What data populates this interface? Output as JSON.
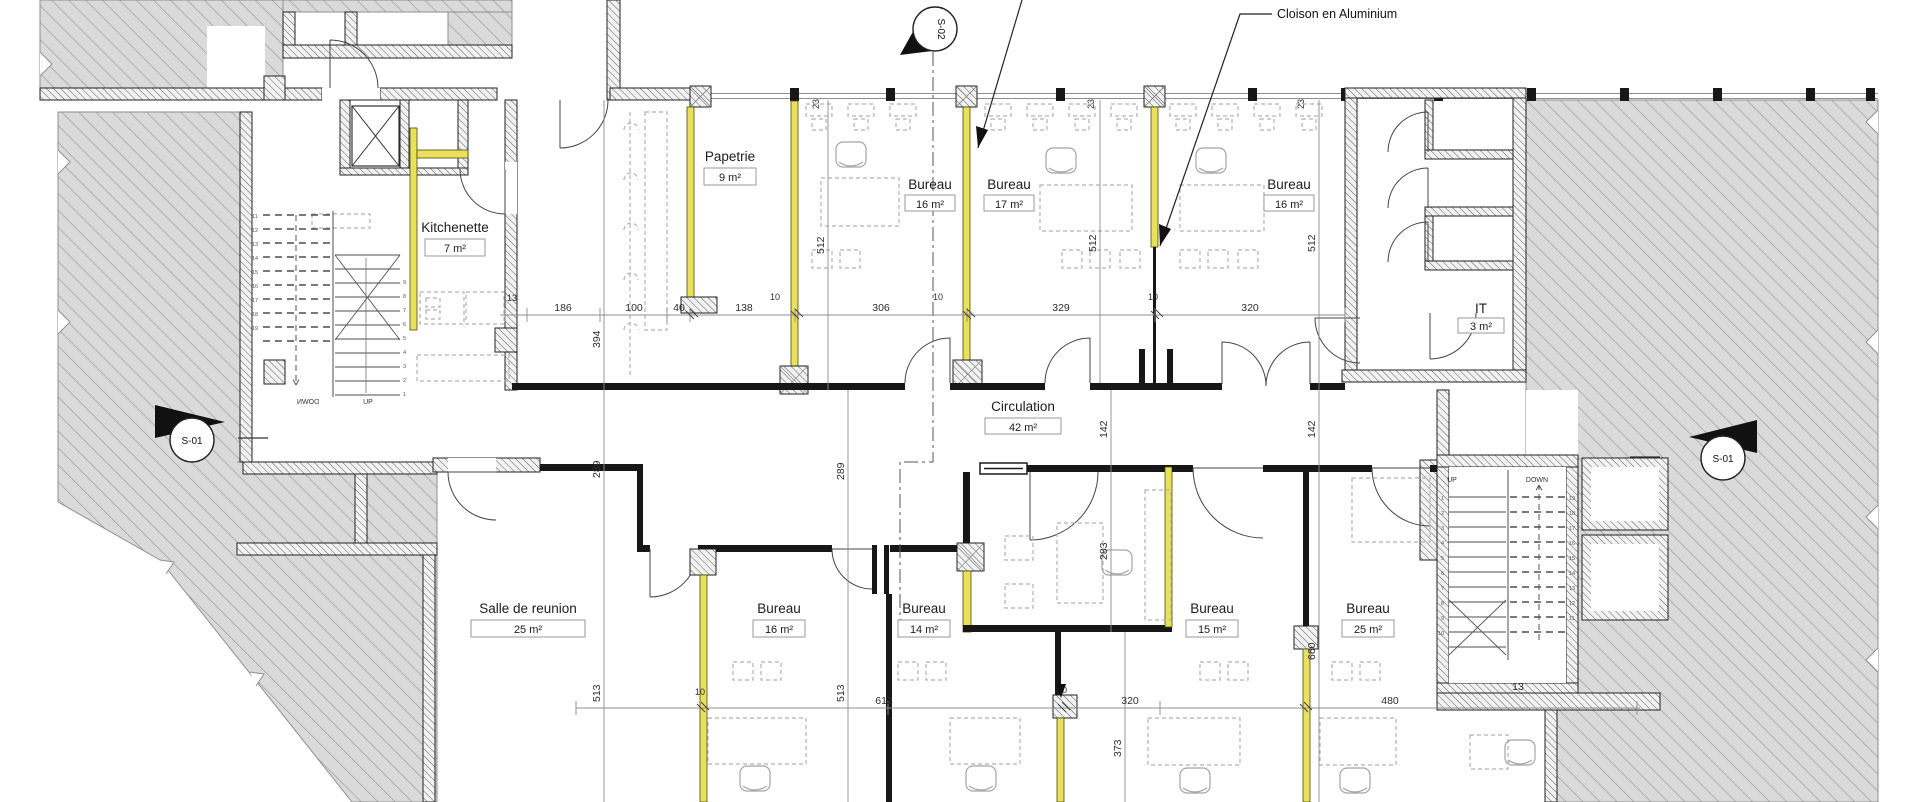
{
  "plan": {
    "annotation": {
      "cloison": "Cloison en Aluminium"
    },
    "rooms": {
      "papetrie": {
        "name": "Papetrie",
        "area": "9 m²"
      },
      "kitchenette": {
        "name": "Kitchenette",
        "area": "7 m²"
      },
      "bureau_t1": {
        "name": "Bureau",
        "area": "16 m²"
      },
      "bureau_t2": {
        "name": "Bureau",
        "area": "17 m²"
      },
      "bureau_t3": {
        "name": "Bureau",
        "area": "16 m²"
      },
      "it": {
        "name": "IT",
        "area": "3 m²"
      },
      "circulation": {
        "name": "Circulation",
        "area": "42 m²"
      },
      "salle": {
        "name": "Salle de reunion",
        "area": "25 m²"
      },
      "bureau_b1": {
        "name": "Bureau",
        "area": "16 m²"
      },
      "bureau_b2": {
        "name": "Bureau",
        "area": "14 m²"
      },
      "bureau_b3": {
        "name": "Bureau",
        "area": "15 m²"
      },
      "bureau_b4": {
        "name": "Bureau",
        "area": "25 m²"
      }
    },
    "markers": {
      "s01": "S-01",
      "s02": "S-02"
    },
    "stairs": {
      "up": "UP",
      "down": "DOWN",
      "risers": [
        "1",
        "2",
        "3",
        "4",
        "5",
        "6",
        "7",
        "8",
        "9",
        "10",
        "11",
        "12",
        "13",
        "14",
        "15",
        "16",
        "17",
        "18",
        "19"
      ]
    },
    "dims": {
      "top": [
        "13",
        "186",
        "100",
        "40",
        "138",
        "306",
        "329",
        "320"
      ],
      "bottom": [
        "612",
        "320",
        "480",
        "13"
      ],
      "v": {
        "v394": "394",
        "v512": "512",
        "v289": "289",
        "v513": "513",
        "v142": "142",
        "v283": "283",
        "v660": "660",
        "v373": "373",
        "v23": "23",
        "v10": "10"
      }
    }
  }
}
